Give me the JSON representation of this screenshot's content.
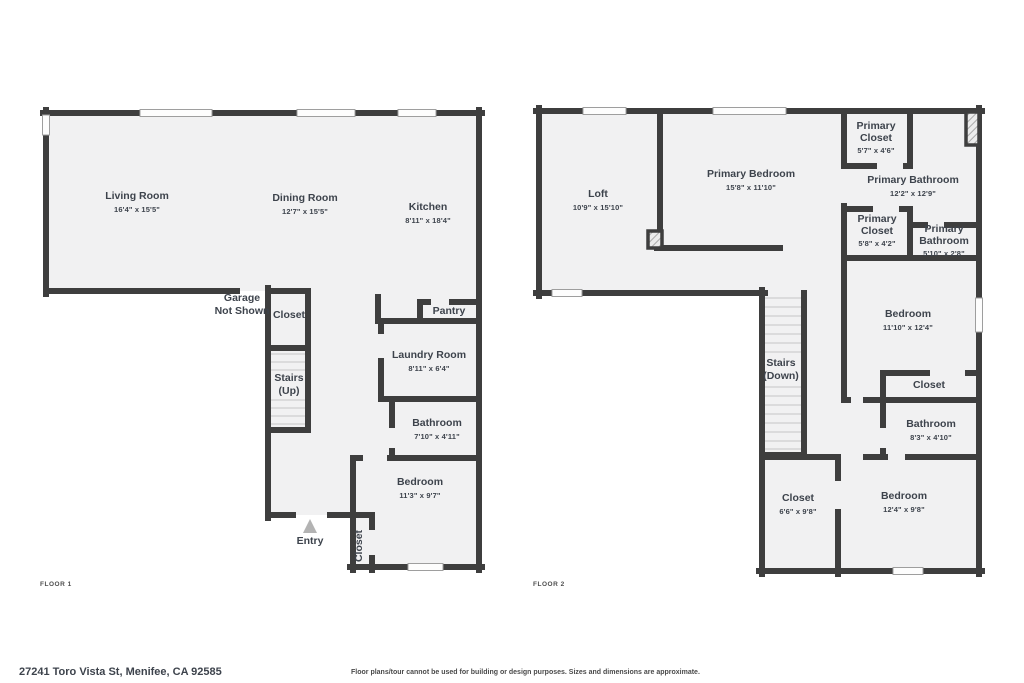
{
  "palette": {
    "wall": "#3e3e3e",
    "room_fill": "#f1f1f2",
    "window_fill": "#fdfdfd",
    "window_stroke": "#9e9e9e",
    "text": "#3d434c",
    "entry_arrow": "#b3b3b3"
  },
  "floor1": {
    "label": "FLOOR 1",
    "rooms": [
      {
        "name": "Living Room",
        "dims": "16'4\" x 15'5\""
      },
      {
        "name": "Dining Room",
        "dims": "12'7\" x 15'5\""
      },
      {
        "name": "Kitchen",
        "dims": "8'11\" x 18'4\""
      },
      {
        "name": "Garage",
        "name2": "Not Shown"
      },
      {
        "name": "Closet"
      },
      {
        "name": "Stairs",
        "name2": "(Up)"
      },
      {
        "name": "Pantry"
      },
      {
        "name": "Laundry Room",
        "dims": "8'11\" x 6'4\""
      },
      {
        "name": "Bathroom",
        "dims": "7'10\" x 4'11\""
      },
      {
        "name": "Bedroom",
        "dims": "11'3\" x 9'7\""
      },
      {
        "name": "Entry"
      },
      {
        "name": "Closet"
      }
    ]
  },
  "floor2": {
    "label": "FLOOR 2",
    "rooms": [
      {
        "name": "Loft",
        "dims": "10'9\" x 15'10\""
      },
      {
        "name": "Primary Bedroom",
        "dims": "15'8\" x 11'10\""
      },
      {
        "name": "Primary",
        "name2": "Closet",
        "dims": "5'7\" x 4'6\""
      },
      {
        "name": "Primary Bathroom",
        "dims": "12'2\" x 12'9\""
      },
      {
        "name": "Primary",
        "name2": "Closet",
        "dims": "5'8\" x 4'2\""
      },
      {
        "name": "Primary",
        "name2": "Bathroom",
        "dims": "5'10\" x 2'8\""
      },
      {
        "name": "Bedroom",
        "dims": "11'10\" x 12'4\""
      },
      {
        "name": "Stairs",
        "name2": "(Down)"
      },
      {
        "name": "Closet"
      },
      {
        "name": "Bathroom",
        "dims": "8'3\" x 4'10\""
      },
      {
        "name": "Closet",
        "dims": "6'6\" x 9'8\""
      },
      {
        "name": "Bedroom",
        "dims": "12'4\" x 9'8\""
      }
    ]
  },
  "footer": {
    "address": "27241 Toro Vista St, Menifee, CA 92585",
    "disclaimer": "Floor plans/tour cannot be used for building or design purposes. Sizes and dimensions are approximate."
  }
}
